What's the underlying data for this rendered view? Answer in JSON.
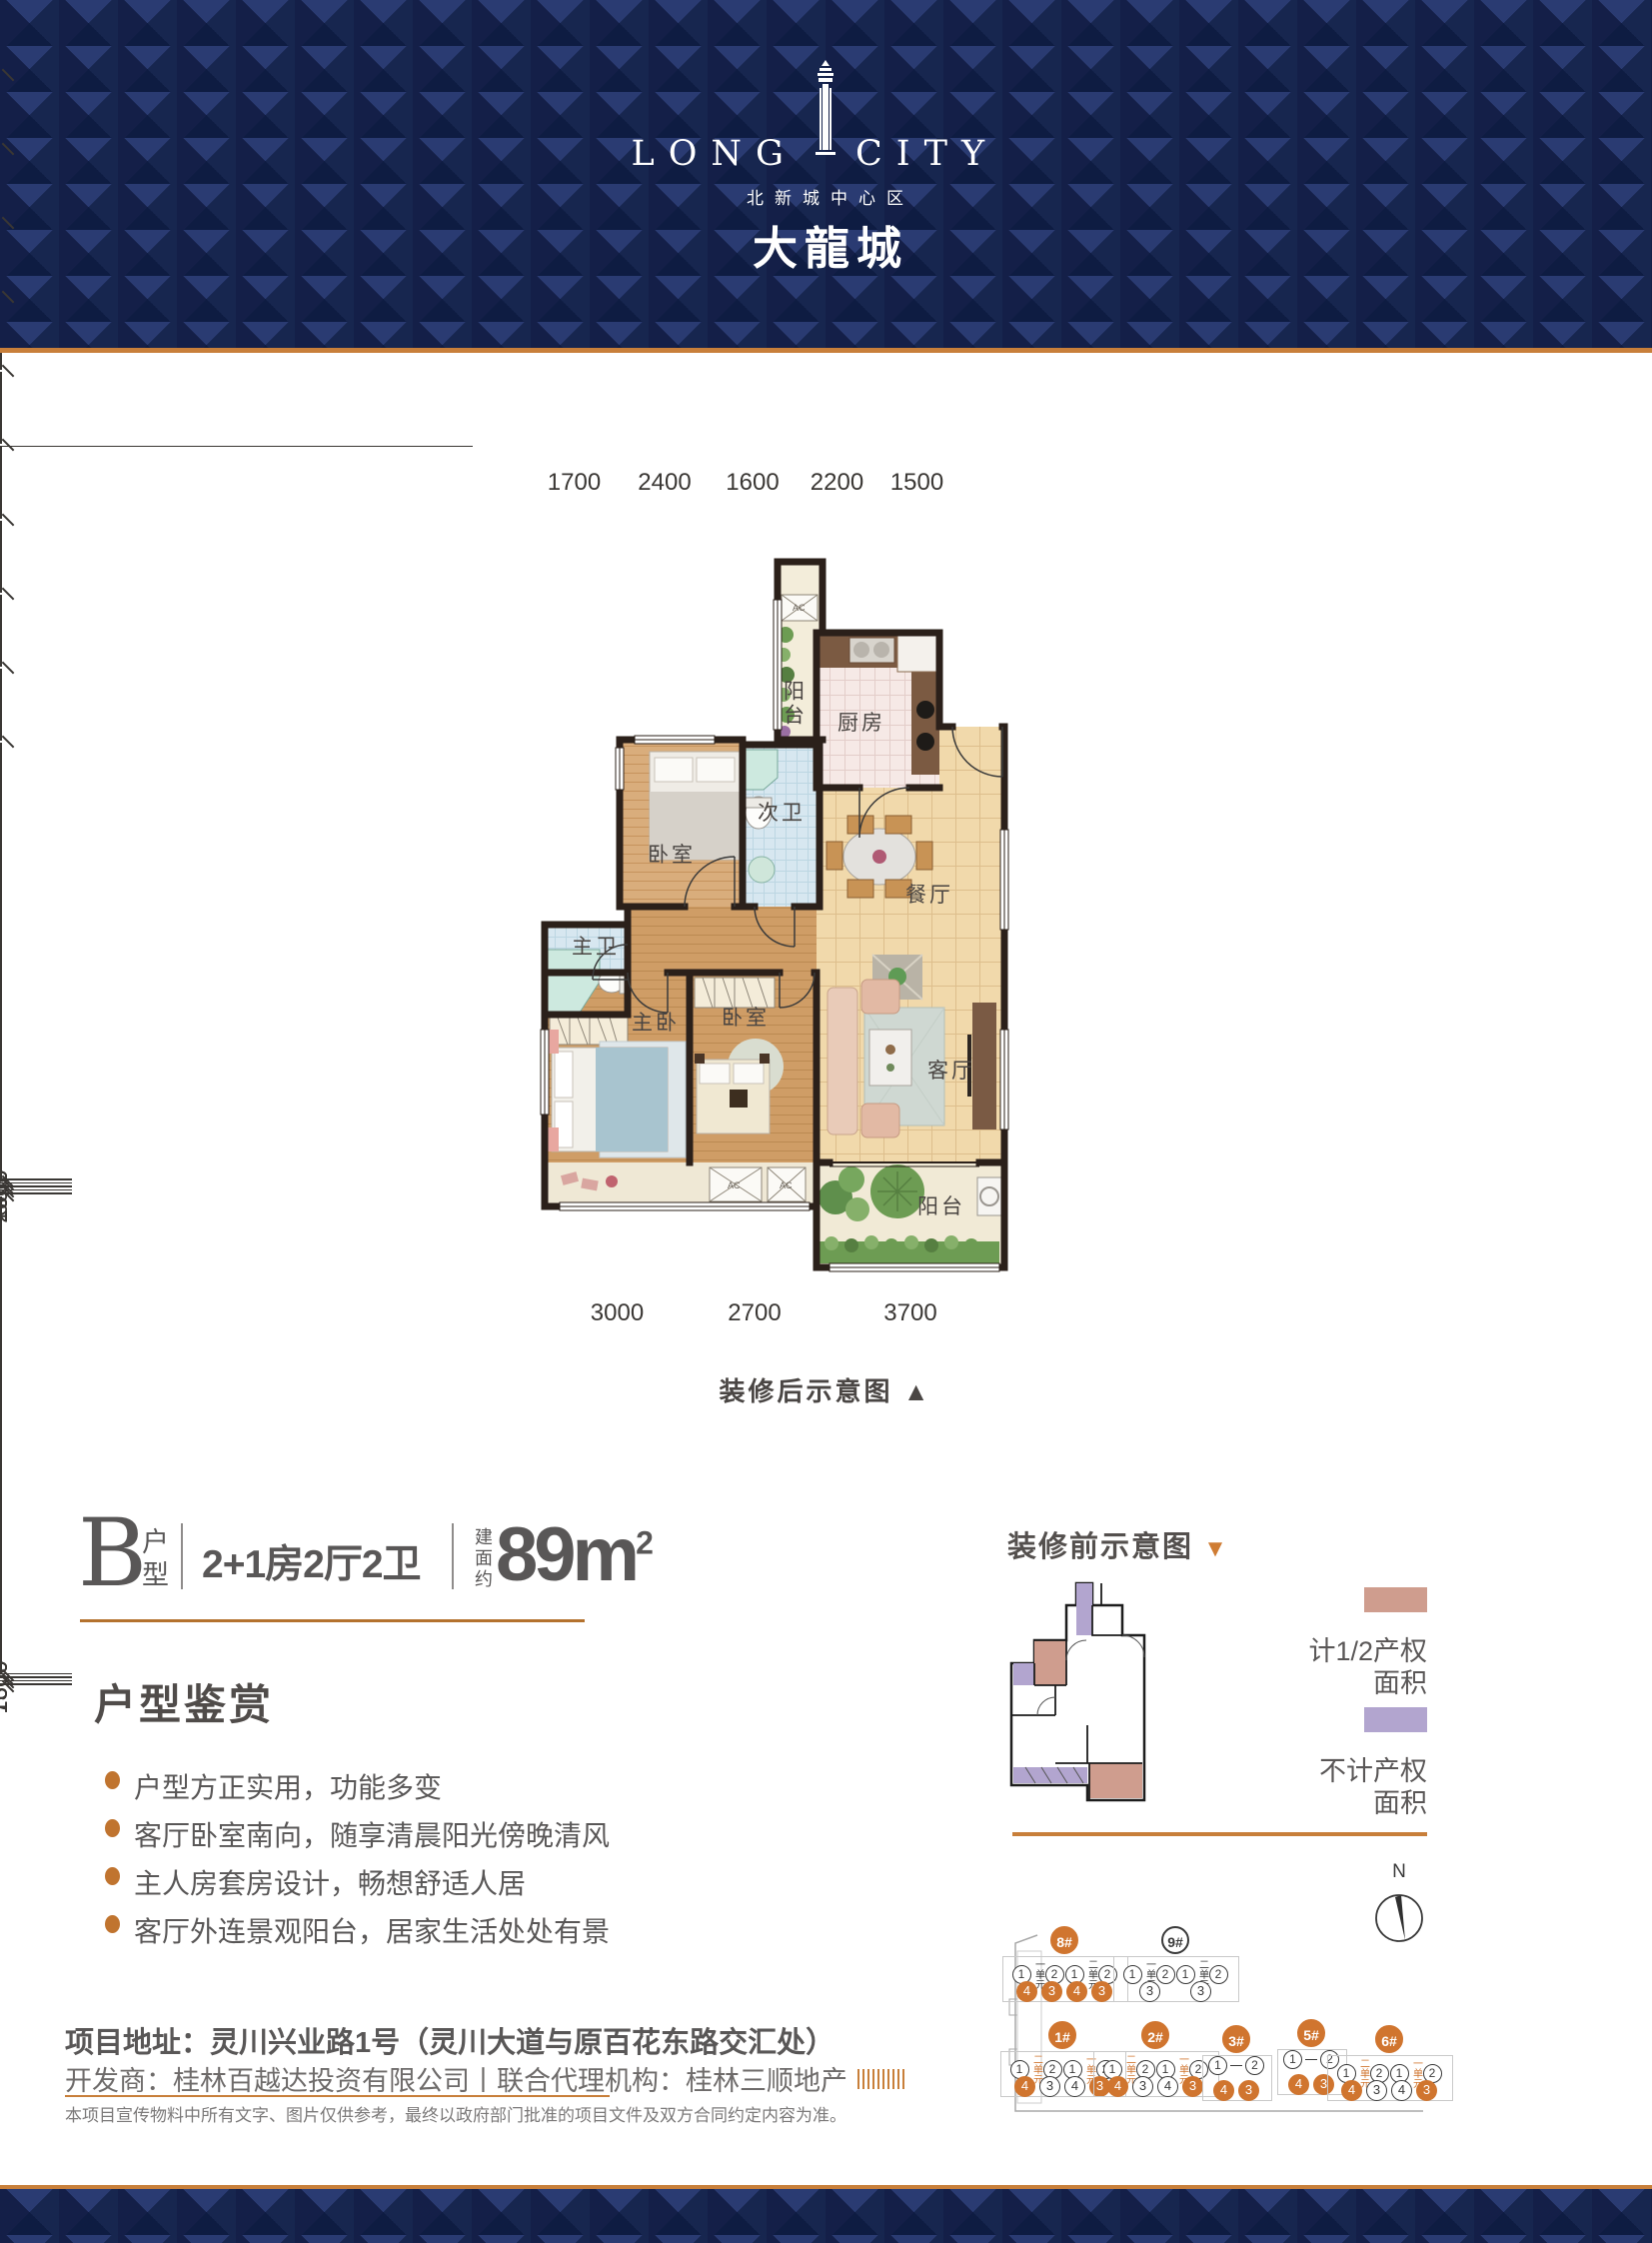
{
  "header": {
    "en_left": "LONG",
    "en_right": "CITY",
    "subtitle": "北新城中心区",
    "title_cn": "大龍城"
  },
  "floorplan": {
    "caption": "装修后示意图",
    "caption_arrow": "▲",
    "dims": {
      "top": [
        "1700",
        "2400",
        "1600",
        "2200",
        "1500"
      ],
      "bottom": [
        "3000",
        "2700",
        "3700"
      ],
      "left": [
        "2600",
        "1600",
        "2900",
        "600"
      ],
      "right": [
        "1600",
        "7300",
        "1600"
      ]
    },
    "rooms": {
      "balcony_top": "阳台",
      "kitchen": "厨房",
      "bath2": "次卫",
      "bedroom1": "卧室",
      "dining": "餐厅",
      "bath_master": "主卫",
      "master": "主卧",
      "bedroom2": "卧室",
      "living": "客厅",
      "balcony_bottom": "阳台",
      "ac1": "AC",
      "ac2": "AC",
      "ac3": "AC"
    }
  },
  "unit": {
    "letter": "B",
    "letter_label": "户型",
    "spec": "2+1房2厅2卫",
    "area_label": "建面约",
    "area_value": "89m",
    "area_sup": "2"
  },
  "appreciation": {
    "title": "户型鉴赏",
    "bullets": [
      "户型方正实用，功能多变",
      "客厅卧室南向，随享清晨阳光傍晚清风",
      "主人房套房设计，畅想舒适人居",
      "客厅外连景观阳台，居家生活处处有景"
    ]
  },
  "address": {
    "line1": "项目地址：灵川兴业路1号（灵川大道与原百花东路交汇处）",
    "line2": "开发商：桂林百越达投资有限公司丨联合代理机构：桂林三顺地产",
    "disclaimer": "本项目宣传物料中所有文字、图片仅供参考，最终以政府部门批准的项目文件及双方合同约定内容为准。"
  },
  "before": {
    "title": "装修前示意图",
    "arrow": "▼",
    "legend": [
      {
        "color": "#cf9d8e",
        "line1": "计1/2产权",
        "line2": "面积"
      },
      {
        "color": "#b2a5cf",
        "line1": "不计产权",
        "line2": "面积"
      }
    ]
  },
  "siteplan": {
    "north": "N",
    "buildings": [
      {
        "id": "8#",
        "big": "filled",
        "units": [
          {
            "v": "1"
          },
          {
            "v": "一单元",
            "u": 1
          },
          {
            "v": "2"
          },
          {
            "v": "1"
          },
          {
            "v": "二单元",
            "u": 1
          },
          {
            "v": "2"
          }
        ],
        "nums": [
          {
            "v": "4",
            "f": 1
          },
          {
            "v": "3",
            "f": 1
          },
          {
            "v": "4",
            "f": 1
          },
          {
            "v": "3",
            "f": 1
          }
        ]
      },
      {
        "id": "9#",
        "big": "outline",
        "units": [
          {
            "v": "1"
          },
          {
            "v": "一单元",
            "u": 1
          },
          {
            "v": "2"
          },
          {
            "v": "1"
          },
          {
            "v": "二单元",
            "u": 1
          },
          {
            "v": "2"
          }
        ],
        "nums": [
          {
            "v": "3"
          },
          {
            "v": "3"
          }
        ],
        "numgap": 30
      },
      {
        "id": "1#",
        "big": "filled",
        "units": [
          {
            "v": "1"
          },
          {
            "v": "二单元",
            "u": 1,
            "o": 1
          },
          {
            "v": "2"
          },
          {
            "v": "1"
          },
          {
            "v": "一单元",
            "u": 1,
            "o": 1
          },
          {
            "v": "2"
          }
        ],
        "nums": [
          {
            "v": "4",
            "f": 1
          },
          {
            "v": "3"
          },
          {
            "v": "4"
          },
          {
            "v": "3",
            "f": 1
          }
        ]
      },
      {
        "id": "2#",
        "big": "filled",
        "units": [
          {
            "v": "1"
          },
          {
            "v": "二单元",
            "u": 1,
            "o": 1
          },
          {
            "v": "2"
          },
          {
            "v": "1"
          },
          {
            "v": "一单元",
            "u": 1,
            "o": 1
          },
          {
            "v": "2"
          }
        ],
        "nums": [
          {
            "v": "4",
            "f": 1
          },
          {
            "v": "3"
          },
          {
            "v": "4"
          },
          {
            "v": "3",
            "f": 1
          }
        ]
      },
      {
        "id": "3#",
        "big": "filled",
        "units": [
          {
            "v": "1"
          },
          {
            "v": "-"
          },
          {
            "v": "2"
          }
        ],
        "nums": [
          {
            "v": "4",
            "f": 1
          },
          {
            "v": "3",
            "f": 1
          }
        ]
      },
      {
        "id": "5#",
        "big": "filled",
        "units": [
          {
            "v": "1"
          },
          {
            "v": "-"
          },
          {
            "v": "2"
          }
        ],
        "nums": [
          {
            "v": "4",
            "f": 1
          },
          {
            "v": "3",
            "f": 1
          }
        ]
      },
      {
        "id": "6#",
        "big": "filled",
        "units": [
          {
            "v": "1"
          },
          {
            "v": "二单元",
            "u": 1,
            "o": 1
          },
          {
            "v": "2"
          },
          {
            "v": "1"
          },
          {
            "v": "一单元",
            "u": 1,
            "o": 1
          },
          {
            "v": "2"
          }
        ],
        "nums": [
          {
            "v": "4",
            "f": 1
          },
          {
            "v": "3"
          },
          {
            "v": "4"
          },
          {
            "v": "3",
            "f": 1
          }
        ]
      }
    ]
  },
  "colors": {
    "navy": "#1b2a58",
    "accent": "#c87f3a",
    "site_orange": "#d0752f",
    "legend_pink": "#cf9d8e",
    "legend_purple": "#b2a5cf",
    "text_gray": "#595757"
  }
}
